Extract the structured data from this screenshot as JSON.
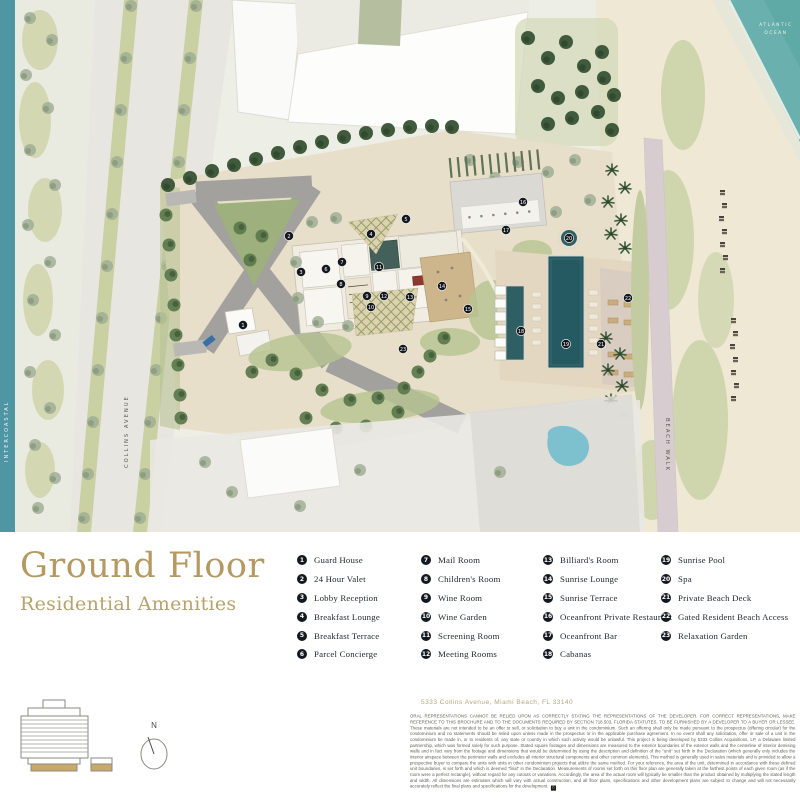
{
  "title": {
    "line1": "Ground Floor",
    "line2": "Residential Amenities"
  },
  "legend": {
    "columns": [
      [
        {
          "num": "1",
          "label": "Guard House"
        },
        {
          "num": "2",
          "label": "24 Hour Valet"
        },
        {
          "num": "3",
          "label": "Lobby Reception"
        },
        {
          "num": "4",
          "label": "Breakfast Lounge"
        },
        {
          "num": "5",
          "label": "Breakfast Terrace"
        },
        {
          "num": "6",
          "label": "Parcel Concierge"
        }
      ],
      [
        {
          "num": "7",
          "label": "Mail Room"
        },
        {
          "num": "8",
          "label": "Children's Room"
        },
        {
          "num": "9",
          "label": "Wine Room"
        },
        {
          "num": "10",
          "label": "Wine Garden"
        },
        {
          "num": "11",
          "label": "Screening Room"
        },
        {
          "num": "12",
          "label": "Meeting Rooms"
        }
      ],
      [
        {
          "num": "13",
          "label": "Billiard's Room"
        },
        {
          "num": "14",
          "label": "Sunrise Lounge"
        },
        {
          "num": "15",
          "label": "Sunrise Terrace"
        },
        {
          "num": "16",
          "label": "Oceanfront Private Restaurant"
        },
        {
          "num": "17",
          "label": "Oceanfront Bar"
        },
        {
          "num": "18",
          "label": "Cabanas"
        }
      ],
      [
        {
          "num": "19",
          "label": "Sunrise Pool"
        },
        {
          "num": "20",
          "label": "Spa"
        },
        {
          "num": "21",
          "label": "Private Beach Deck"
        },
        {
          "num": "22",
          "label": "Gated Resident Beach Access"
        },
        {
          "num": "23",
          "label": "Relaxation Garden"
        }
      ]
    ]
  },
  "map": {
    "labels": {
      "ocean_line1": "ATLANTIC",
      "ocean_line2": "OCEAN",
      "intercoastal": "INTERCOASTAL",
      "collins": "COLLINS AVENUE",
      "beachwalk": "BEACH WALK"
    },
    "markers": [
      {
        "n": "1",
        "x": 243,
        "y": 325
      },
      {
        "n": "2",
        "x": 289,
        "y": 236
      },
      {
        "n": "3",
        "x": 301,
        "y": 272
      },
      {
        "n": "4",
        "x": 371,
        "y": 234
      },
      {
        "n": "5",
        "x": 406,
        "y": 219
      },
      {
        "n": "6",
        "x": 326,
        "y": 269
      },
      {
        "n": "7",
        "x": 342,
        "y": 262
      },
      {
        "n": "8",
        "x": 341,
        "y": 284
      },
      {
        "n": "9",
        "x": 367,
        "y": 296
      },
      {
        "n": "10",
        "x": 371,
        "y": 307
      },
      {
        "n": "11",
        "x": 379,
        "y": 267
      },
      {
        "n": "12",
        "x": 384,
        "y": 296
      },
      {
        "n": "13",
        "x": 410,
        "y": 297
      },
      {
        "n": "14",
        "x": 442,
        "y": 286
      },
      {
        "n": "15",
        "x": 468,
        "y": 309
      },
      {
        "n": "16",
        "x": 523,
        "y": 202
      },
      {
        "n": "17",
        "x": 506,
        "y": 230
      },
      {
        "n": "18",
        "x": 521,
        "y": 331
      },
      {
        "n": "19",
        "x": 566,
        "y": 344
      },
      {
        "n": "20",
        "x": 569,
        "y": 238
      },
      {
        "n": "21",
        "x": 601,
        "y": 344
      },
      {
        "n": "22",
        "x": 628,
        "y": 298
      },
      {
        "n": "23",
        "x": 403,
        "y": 349
      }
    ]
  },
  "footer": {
    "address": "5333 Collins Avenue, Miami Beach, FL 33140",
    "compass_n": "N",
    "disclaimer": "ORAL REPRESENTATIONS CANNOT BE RELIED UPON AS CORRECTLY STATING THE REPRESENTATIONS OF THE DEVELOPER. FOR CORRECT REPRESENTATIONS, MAKE REFERENCE TO THIS BROCHURE AND TO THE DOCUMENTS REQUIRED BY SECTION 718.503, FLORIDA STATUTES, TO BE FURNISHED BY A DEVELOPER TO A BUYER OR LESSEE. These materials are not intended to be an offer to sell, or solicitation to buy a unit in the condominium. Such an offering shall only be made pursuant to the prospectus (offering circular) for the condominium and no statements should be relied upon unless made in the prospectus or in the applicable purchase agreement. In no event shall any solicitation, offer or sale of a unit in the condominium be made in, or to residents of, any state or country in which such activity would be unlawful. This project is being developed by 5333 Collins Acquisitions, LP, a Delaware limited partnership, which was formed solely for such purpose. Stated square footages and dimensions are measured to the exterior boundaries of the exterior walls and the centerline of interior demising walls and in fact vary from the footage and dimensions that would be determined by using the description and definition of the \"unit\" set forth in the Declaration (which generally only includes the interior airspace between the perimeter walls and excludes all interior structural components and other common elements). This method is generally used in sales materials and is provided to allow a prospective buyer to compare the units with units in other condominium projects that utilize the same method. For your reference, the area of the unit, determined in accordance with these defined unit boundaries, is set forth and which is deemed \"final\" in the Declaration. Measurements of rooms set forth on this floor plan are generally taken at the farthest points of each given room (as if the room were a perfect rectangle), without regard for any cutouts or variations. Accordingly, the area of the actual room will typically be smaller than the product obtained by multiplying the stated length and width. All dimensions are estimates which will vary with actual construction, and all floor plans, specifications and other development plans are subject to change and will not necessarily accurately reflect the final plans and specifications for the development."
  },
  "colors": {
    "gold": "#b49a62",
    "ink": "#14181f",
    "ocean": "#6ab0ae",
    "intercoastal": "#4f96a4",
    "pool": "#265a62",
    "sand": "#efe7d3"
  }
}
